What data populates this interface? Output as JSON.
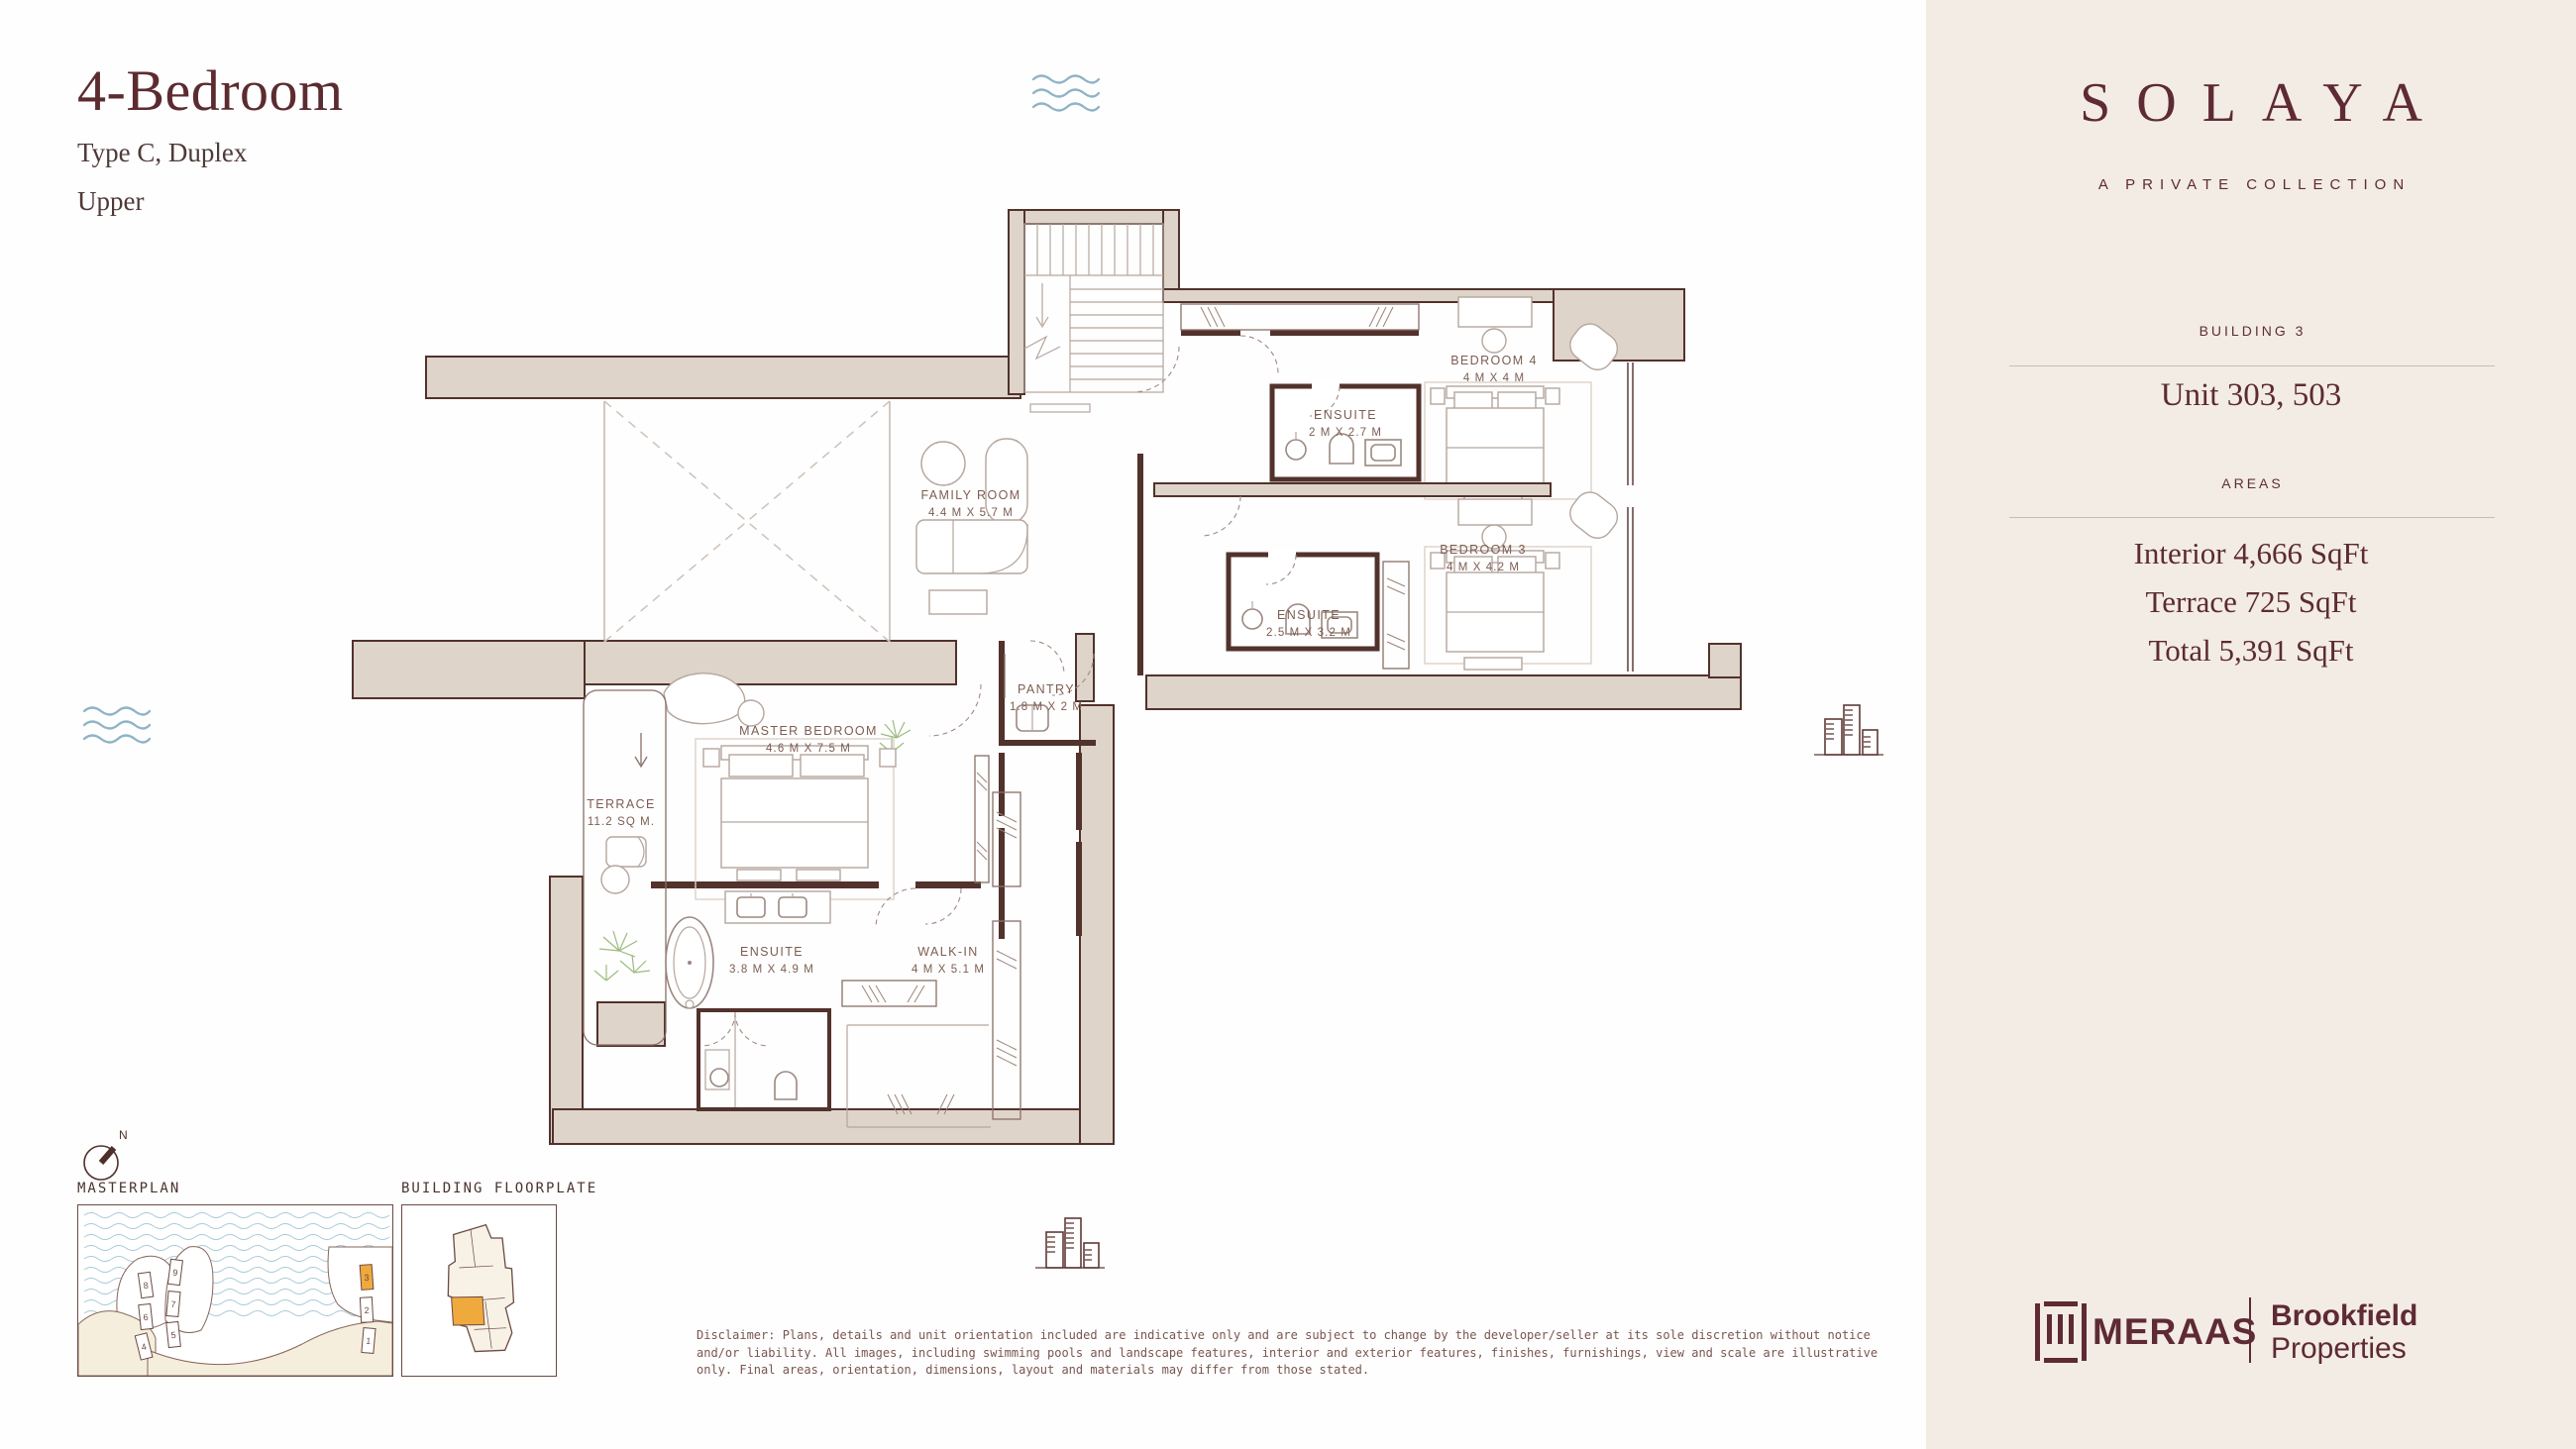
{
  "header": {
    "title": "4-Bedroom",
    "subtitle": "Type C, Duplex",
    "level": "Upper"
  },
  "sidebar": {
    "brand": "SOLAYA",
    "tagline": "A PRIVATE COLLECTION",
    "building": "BUILDING 3",
    "unit": "Unit 303, 503",
    "areas_heading": "AREAS",
    "area_interior": "Interior 4,666 SqFt",
    "area_terrace": "Terrace 725 SqFt",
    "area_total": "Total 5,391 SqFt",
    "developer": "MERAAS",
    "partner_line1": "Brookfield",
    "partner_line2": "Properties"
  },
  "plan": {
    "rooms": {
      "family": {
        "name": "FAMILY ROOM",
        "dims": "4.4 M X 5.7 M"
      },
      "bedroom4": {
        "name": "BEDROOM 4",
        "dims": "4 M X 4 M"
      },
      "ensuite4": {
        "name": "ENSUITE",
        "dims": "2 M X 2.7 M"
      },
      "bedroom3": {
        "name": "BEDROOM 3",
        "dims": "4 M X 4.2 M"
      },
      "ensuite3": {
        "name": "ENSUITE",
        "dims": "2.5 M X 3.2 M"
      },
      "master": {
        "name": "MASTER BEDROOM",
        "dims": "4.6 M X 7.5 M"
      },
      "terrace": {
        "name": "TERRACE",
        "dims": "11.2 SQ M."
      },
      "pantry": {
        "name": "PANTRY",
        "dims": "1.8 M X 2 M"
      },
      "master_ensuite": {
        "name": "ENSUITE",
        "dims": "3.8 M X 4.9 M"
      },
      "walkin": {
        "name": "WALK-IN",
        "dims": "4 M X 5.1 M"
      }
    },
    "compass_north": "N",
    "thumbnails": {
      "masterplan_label": "MASTERPLAN",
      "floorplate_label": "BUILDING FLOORPLATE",
      "building_numbers": [
        "8",
        "6",
        "4",
        "9",
        "7",
        "5",
        "3",
        "2",
        "1"
      ],
      "highlighted_building": "3"
    }
  },
  "footer": {
    "disclaimer": "Disclaimer: Plans, details and unit orientation included are indicative only and are subject to change by the developer/seller at its sole discretion without notice and/or liability. All images, including swimming pools and landscape features, interior and exterior features, finishes, furnishings, view and scale are illustrative only. Final areas, orientation, dimensions, layout and materials may differ from those stated."
  },
  "colors": {
    "maroon": "#5c2b30",
    "wall_fill": "#ded4c9",
    "wall_line": "#52322c",
    "sidebar_bg": "#f3ece4",
    "accent_orange": "#f0a93c",
    "water_blue": "#8fb3c7",
    "plant_green": "#9cbb7e",
    "furniture_line": "#b5a69d"
  }
}
